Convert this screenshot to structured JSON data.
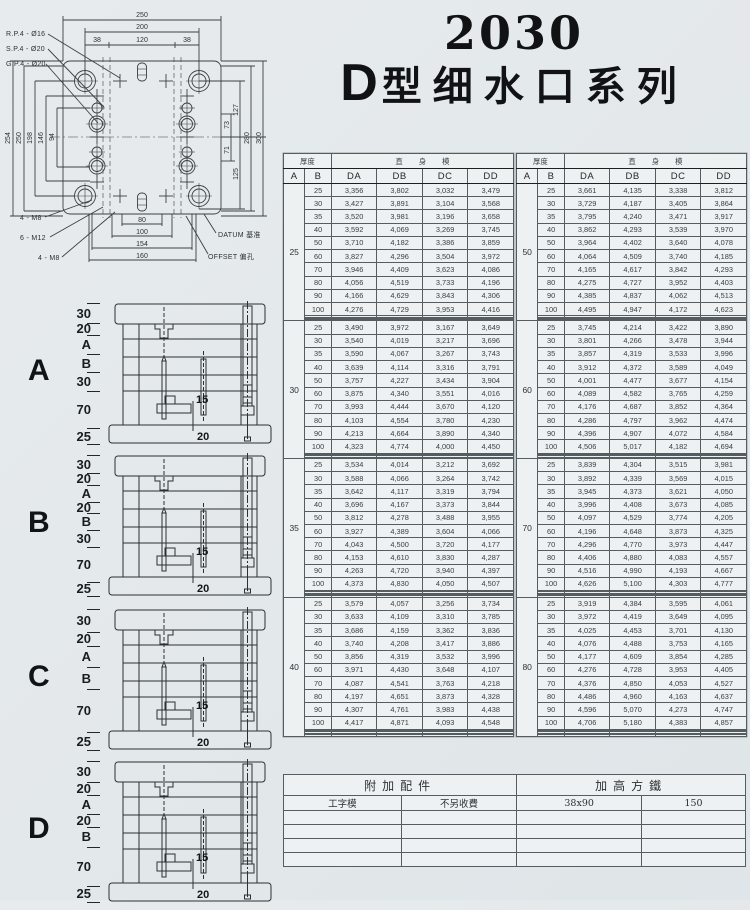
{
  "page": {
    "title_number": "2030",
    "title_prefix": "D",
    "title_series": "型细水口系列"
  },
  "colors": {
    "ink": "#2c3136",
    "paper": "#e6eaec",
    "table_bg": "#eef1f1"
  },
  "plate": {
    "leaders": [
      "R.P.4 - Ø16",
      "S.P.4 - Ø20",
      "G.P.4 - Ø20"
    ],
    "dims_top": [
      "250",
      "200",
      "38",
      "120",
      "38"
    ],
    "dims_left": [
      "254",
      "250",
      "198",
      "146",
      "94"
    ],
    "dims_right": [
      "73",
      "71",
      "127",
      "125",
      "280",
      "300"
    ],
    "dims_bottom": [
      "80",
      "100",
      "154",
      "160"
    ],
    "bolt_labels": [
      "4 - M8",
      "6 - M12",
      "4 - M8"
    ],
    "datum_label": "DATUM 基准",
    "offset_label": "OFFSET 偏孔"
  },
  "sections": [
    {
      "letter": "A",
      "layers": [
        "30",
        "20",
        "A",
        "B",
        "30",
        "70",
        "25"
      ],
      "inner_dims": [
        "15",
        "20"
      ]
    },
    {
      "letter": "B",
      "layers": [
        "30",
        "20",
        "A",
        "20",
        "B",
        "30",
        "70",
        "25"
      ],
      "inner_dims": [
        "15",
        "20"
      ]
    },
    {
      "letter": "C",
      "layers": [
        "30",
        "20",
        "A",
        "B",
        "70",
        "25"
      ],
      "inner_dims": [
        "15",
        "20"
      ]
    },
    {
      "letter": "D",
      "layers": [
        "30",
        "20",
        "A",
        "20",
        "B",
        "70",
        "25"
      ],
      "inner_dims": [
        "15",
        "20"
      ]
    }
  ],
  "tables": {
    "header": {
      "thickness": "厚度",
      "straight_mold": "直身模",
      "col_a": "A",
      "col_b": "B",
      "cols": [
        "DA",
        "DB",
        "DC",
        "DD"
      ]
    },
    "left": {
      "blocks": [
        {
          "a": "25",
          "empty": 4,
          "rows": [
            [
              "25",
              "3,356",
              "3,802",
              "3,032",
              "3,479"
            ],
            [
              "30",
              "3,427",
              "3,891",
              "3,104",
              "3,568"
            ],
            [
              "35",
              "3,520",
              "3,981",
              "3,196",
              "3,658"
            ],
            [
              "40",
              "3,592",
              "4,069",
              "3,269",
              "3,745"
            ],
            [
              "50",
              "3,710",
              "4,182",
              "3,386",
              "3,859"
            ],
            [
              "60",
              "3,827",
              "4,296",
              "3,504",
              "3,972"
            ],
            [
              "70",
              "3,946",
              "4,409",
              "3,623",
              "4,086"
            ],
            [
              "80",
              "4,056",
              "4,519",
              "3,733",
              "4,196"
            ],
            [
              "90",
              "4,166",
              "4,629",
              "3,843",
              "4,306"
            ],
            [
              "100",
              "4,276",
              "4,729",
              "3,953",
              "4,416"
            ]
          ]
        },
        {
          "a": "30",
          "empty": 4,
          "rows": [
            [
              "25",
              "3,490",
              "3,972",
              "3,167",
              "3,649"
            ],
            [
              "30",
              "3,540",
              "4,019",
              "3,217",
              "3,696"
            ],
            [
              "35",
              "3,590",
              "4,067",
              "3,267",
              "3,743"
            ],
            [
              "40",
              "3,639",
              "4,114",
              "3,316",
              "3,791"
            ],
            [
              "50",
              "3,757",
              "4,227",
              "3,434",
              "3,904"
            ],
            [
              "60",
              "3,875",
              "4,340",
              "3,551",
              "4,016"
            ],
            [
              "70",
              "3,993",
              "4,444",
              "3,670",
              "4,120"
            ],
            [
              "80",
              "4,103",
              "4,554",
              "3,780",
              "4,230"
            ],
            [
              "90",
              "4,213",
              "4,664",
              "3,890",
              "4,340"
            ],
            [
              "100",
              "4,323",
              "4,774",
              "4,000",
              "4,450"
            ]
          ]
        },
        {
          "a": "35",
          "empty": 5,
          "rows": [
            [
              "25",
              "3,534",
              "4,014",
              "3,212",
              "3,692"
            ],
            [
              "30",
              "3,588",
              "4,066",
              "3,264",
              "3,742"
            ],
            [
              "35",
              "3,642",
              "4,117",
              "3,319",
              "3,794"
            ],
            [
              "40",
              "3,696",
              "4,167",
              "3,373",
              "3,844"
            ],
            [
              "50",
              "3,812",
              "4,278",
              "3,488",
              "3,955"
            ],
            [
              "60",
              "3,927",
              "4,389",
              "3,604",
              "4,066"
            ],
            [
              "70",
              "4,043",
              "4,500",
              "3,720",
              "4,177"
            ],
            [
              "80",
              "4,153",
              "4,610",
              "3,830",
              "4,287"
            ],
            [
              "90",
              "4,263",
              "4,720",
              "3,940",
              "4,397"
            ],
            [
              "100",
              "4,373",
              "4,830",
              "4,050",
              "4,507"
            ]
          ]
        },
        {
          "a": "40",
          "empty": 5,
          "rows": [
            [
              "25",
              "3,579",
              "4,057",
              "3,256",
              "3,734"
            ],
            [
              "30",
              "3,633",
              "4,109",
              "3,310",
              "3,785"
            ],
            [
              "35",
              "3,686",
              "4,159",
              "3,362",
              "3,836"
            ],
            [
              "40",
              "3,740",
              "4,208",
              "3,417",
              "3,886"
            ],
            [
              "50",
              "3,856",
              "4,319",
              "3,532",
              "3,996"
            ],
            [
              "60",
              "3,971",
              "4,430",
              "3,648",
              "4,107"
            ],
            [
              "70",
              "4,087",
              "4,541",
              "3,763",
              "4,218"
            ],
            [
              "80",
              "4,197",
              "4,651",
              "3,873",
              "4,328"
            ],
            [
              "90",
              "4,307",
              "4,761",
              "3,983",
              "4,438"
            ],
            [
              "100",
              "4,417",
              "4,871",
              "4,093",
              "4,548"
            ]
          ]
        }
      ]
    },
    "right": {
      "blocks": [
        {
          "a": "50",
          "empty": 4,
          "rows": [
            [
              "25",
              "3,661",
              "4,135",
              "3,338",
              "3,812"
            ],
            [
              "30",
              "3,729",
              "4,187",
              "3,405",
              "3,864"
            ],
            [
              "35",
              "3,795",
              "4,240",
              "3,471",
              "3,917"
            ],
            [
              "40",
              "3,862",
              "4,293",
              "3,539",
              "3,970"
            ],
            [
              "50",
              "3,964",
              "4,402",
              "3,640",
              "4,078"
            ],
            [
              "60",
              "4,064",
              "4,509",
              "3,740",
              "4,185"
            ],
            [
              "70",
              "4,165",
              "4,617",
              "3,842",
              "4,293"
            ],
            [
              "80",
              "4,275",
              "4,727",
              "3,952",
              "4,403"
            ],
            [
              "90",
              "4,385",
              "4,837",
              "4,062",
              "4,513"
            ],
            [
              "100",
              "4,495",
              "4,947",
              "4,172",
              "4,623"
            ]
          ]
        },
        {
          "a": "60",
          "empty": 4,
          "rows": [
            [
              "25",
              "3,745",
              "4,214",
              "3,422",
              "3,890"
            ],
            [
              "30",
              "3,801",
              "4,266",
              "3,478",
              "3,944"
            ],
            [
              "35",
              "3,857",
              "4,319",
              "3,533",
              "3,996"
            ],
            [
              "40",
              "3,912",
              "4,372",
              "3,589",
              "4,049"
            ],
            [
              "50",
              "4,001",
              "4,477",
              "3,677",
              "4,154"
            ],
            [
              "60",
              "4,089",
              "4,582",
              "3,765",
              "4,259"
            ],
            [
              "70",
              "4,176",
              "4,687",
              "3,852",
              "4,364"
            ],
            [
              "80",
              "4,286",
              "4,797",
              "3,962",
              "4,474"
            ],
            [
              "90",
              "4,396",
              "4,907",
              "4,072",
              "4,584"
            ],
            [
              "100",
              "4,506",
              "5,017",
              "4,182",
              "4,694"
            ]
          ]
        },
        {
          "a": "70",
          "empty": 5,
          "rows": [
            [
              "25",
              "3,839",
              "4,304",
              "3,515",
              "3,981"
            ],
            [
              "30",
              "3,892",
              "4,339",
              "3,569",
              "4,015"
            ],
            [
              "35",
              "3,945",
              "4,373",
              "3,621",
              "4,050"
            ],
            [
              "40",
              "3,996",
              "4,408",
              "3,673",
              "4,085"
            ],
            [
              "50",
              "4,097",
              "4,529",
              "3,774",
              "4,205"
            ],
            [
              "60",
              "4,196",
              "4,648",
              "3,873",
              "4,325"
            ],
            [
              "70",
              "4,296",
              "4,770",
              "3,973",
              "4,447"
            ],
            [
              "80",
              "4,406",
              "4,880",
              "4,083",
              "4,557"
            ],
            [
              "90",
              "4,516",
              "4,990",
              "4,193",
              "4,667"
            ],
            [
              "100",
              "4,626",
              "5,100",
              "4,303",
              "4,777"
            ]
          ]
        },
        {
          "a": "80",
          "empty": 5,
          "rows": [
            [
              "25",
              "3,919",
              "4,384",
              "3,595",
              "4,061"
            ],
            [
              "30",
              "3,972",
              "4,419",
              "3,649",
              "4,095"
            ],
            [
              "35",
              "4,025",
              "4,453",
              "3,701",
              "4,130"
            ],
            [
              "40",
              "4,076",
              "4,488",
              "3,753",
              "4,165"
            ],
            [
              "50",
              "4,177",
              "4,609",
              "3,854",
              "4,285"
            ],
            [
              "60",
              "4,276",
              "4,728",
              "3,953",
              "4,405"
            ],
            [
              "70",
              "4,376",
              "4,850",
              "4,053",
              "4,527"
            ],
            [
              "80",
              "4,486",
              "4,960",
              "4,163",
              "4,637"
            ],
            [
              "90",
              "4,596",
              "5,070",
              "4,273",
              "4,747"
            ],
            [
              "100",
              "4,706",
              "5,180",
              "4,383",
              "4,857"
            ]
          ]
        }
      ]
    }
  },
  "accessory": {
    "left_header": "附加配件",
    "right_header": "加高方鐵",
    "row": [
      "工字模",
      "不另收費",
      "38x90",
      "150"
    ],
    "empty_rows": 4
  }
}
